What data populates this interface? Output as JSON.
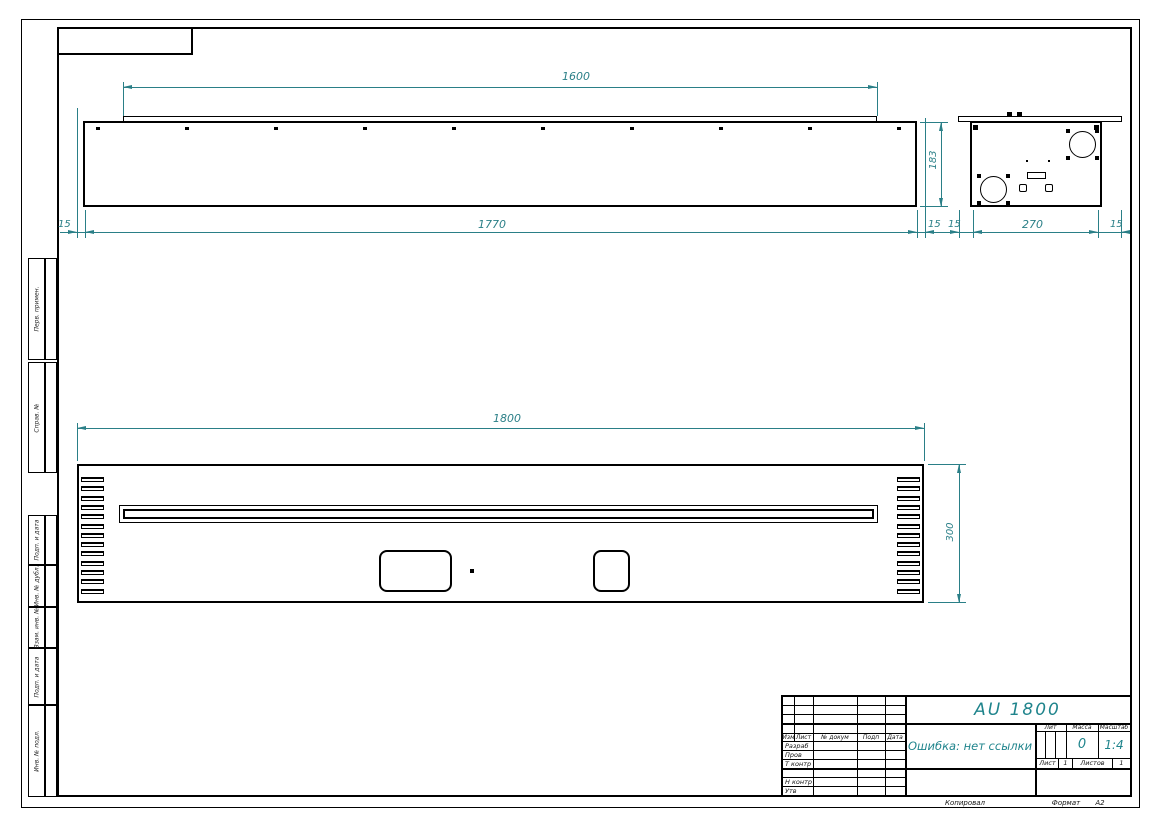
{
  "colors": {
    "dimension": "#2a7f87",
    "line": "#000000",
    "accent_text": "#1f848c"
  },
  "dimensions": {
    "top_plate_width": "1600",
    "body_width": "1770",
    "edge_offset": "15",
    "body_depth": "183",
    "side_body_width": "270",
    "overall_width": "1800",
    "front_height": "300"
  },
  "margin_labels": {
    "items": [
      {
        "label": "Перв. примен."
      },
      {
        "label": "Справ. №"
      },
      {
        "label": "Подп. и дата"
      },
      {
        "label": "Инв. № дубл."
      },
      {
        "label": "Взам. инв. №"
      },
      {
        "label": "Подп. и дата"
      },
      {
        "label": "Инв. № подл."
      }
    ]
  },
  "title_block": {
    "title": "AU 1800",
    "note": "Ошибка: нет ссылки",
    "header_cols": [
      "Изм",
      "Лист",
      "№ докум",
      "Подп",
      "Дата"
    ],
    "row_labels": [
      "Разраб",
      "Пров",
      "Т контр",
      "Н контр",
      "Утв"
    ],
    "lit_label": "Лит",
    "mass_label": "Масса",
    "scale_label": "Масштаб",
    "mass_value": "0",
    "scale_value": "1:4",
    "sheet_label": "Лист",
    "sheet_value": "1",
    "sheets_label": "Листов",
    "sheets_value": "1"
  },
  "footer": {
    "copied_label": "Копировал",
    "format_label": "Формат",
    "format_value": "А2"
  }
}
